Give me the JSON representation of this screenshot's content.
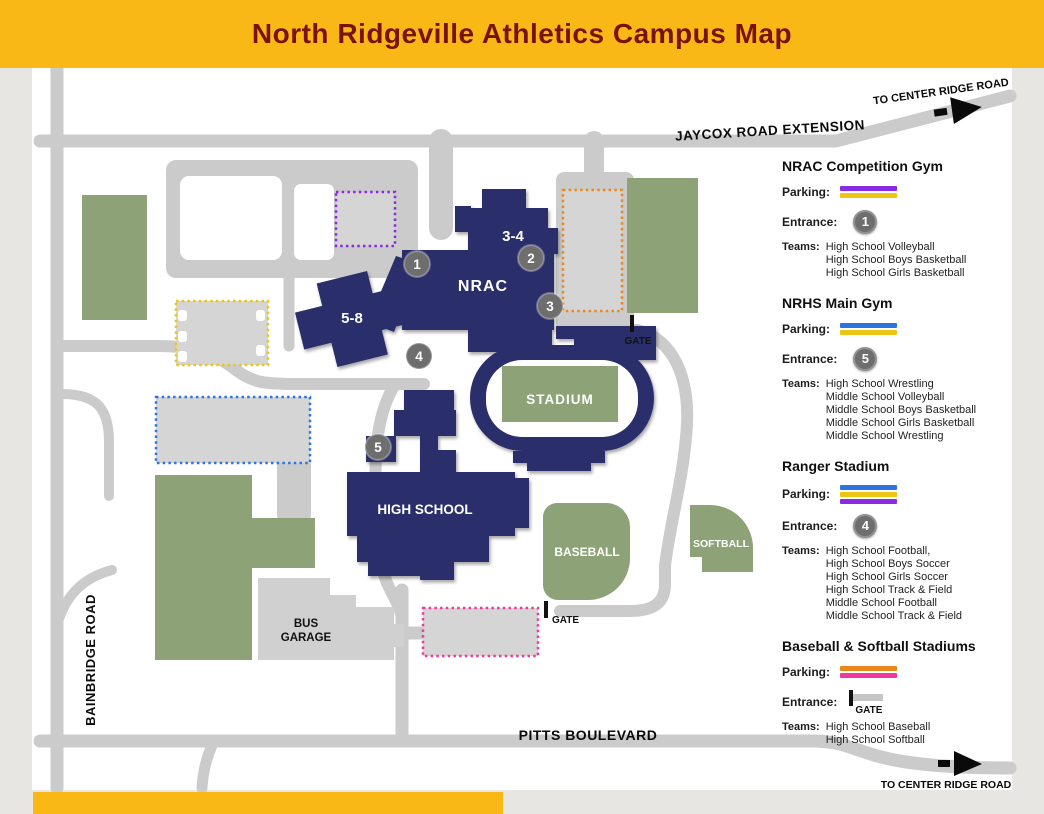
{
  "header": {
    "title": "North Ridgeville Athletics Campus Map",
    "bg": "#f9b816",
    "title_color": "#7a120c"
  },
  "map": {
    "roads": {
      "jaycox": "JAYCOX ROAD EXTENSION",
      "bainbridge": "BAINBRIDGE ROAD",
      "pitts": "PITTS BOULEVARD",
      "to_center_ridge_top": "TO CENTER RIDGE ROAD",
      "to_center_ridge_bottom": "TO CENTER RIDGE ROAD"
    },
    "buildings": {
      "nrac": "NRAC",
      "grades_34": "3-4",
      "grades_58": "5-8",
      "high_school": "HIGH SCHOOL",
      "stadium": "STADIUM",
      "bus_garage_line1": "BUS",
      "bus_garage_line2": "GARAGE"
    },
    "fields": {
      "baseball": "BASEBALL",
      "softball": "SOFTBALL"
    },
    "gates": {
      "nrac_gate": "GATE",
      "south_gate": "GATE"
    },
    "markers": [
      {
        "label": "1"
      },
      {
        "label": "2"
      },
      {
        "label": "3"
      },
      {
        "label": "4"
      },
      {
        "label": "5"
      }
    ],
    "colors": {
      "building": "#2b2e6a",
      "field": "#8da377",
      "road": "#cbcbcb",
      "lot": "#d5d5d5",
      "garage": "#d0d0d0",
      "marker": "#6e6e6e",
      "sheet": "#ffffff"
    },
    "lot_outline_colors": {
      "purple": "#8a2be2",
      "orange": "#e8891d",
      "yellow": "#ecc515",
      "blue": "#2e74dd",
      "pink": "#f0399c"
    }
  },
  "legend": {
    "parking_label": "Parking:",
    "entrance_label": "Entrance:",
    "teams_label": "Teams:",
    "gate_label": "GATE",
    "sections": [
      {
        "title": "NRAC Competition Gym",
        "parking_colors": [
          "#8a2be2",
          "#ecc515"
        ],
        "entrance_marker": "1",
        "teams": [
          "High School Volleyball",
          "High School Boys Basketball",
          "High School Girls Basketball"
        ]
      },
      {
        "title": "NRHS Main Gym",
        "parking_colors": [
          "#2e74dd",
          "#ecc515"
        ],
        "entrance_marker": "5",
        "teams": [
          "High School Wrestling",
          "Middle School Volleyball",
          "Middle School Boys Basketball",
          "Middle School Girls Basketball",
          "Middle School Wrestling"
        ]
      },
      {
        "title": "Ranger Stadium",
        "parking_colors": [
          "#2e74dd",
          "#ecc515",
          "#8a2be2"
        ],
        "entrance_marker": "4",
        "teams": [
          "High School Football,",
          "High School Boys Soccer",
          "High School Girls Soccer",
          "High School Track & Field",
          "Middle School Football",
          "Middle School Track & Field"
        ]
      },
      {
        "title": "Baseball & Softball Stadiums",
        "parking_colors": [
          "#e8891d",
          "#f0399c"
        ],
        "entrance_marker": "GATE",
        "teams": [
          "High School Baseball",
          "High School Softball"
        ]
      }
    ]
  }
}
